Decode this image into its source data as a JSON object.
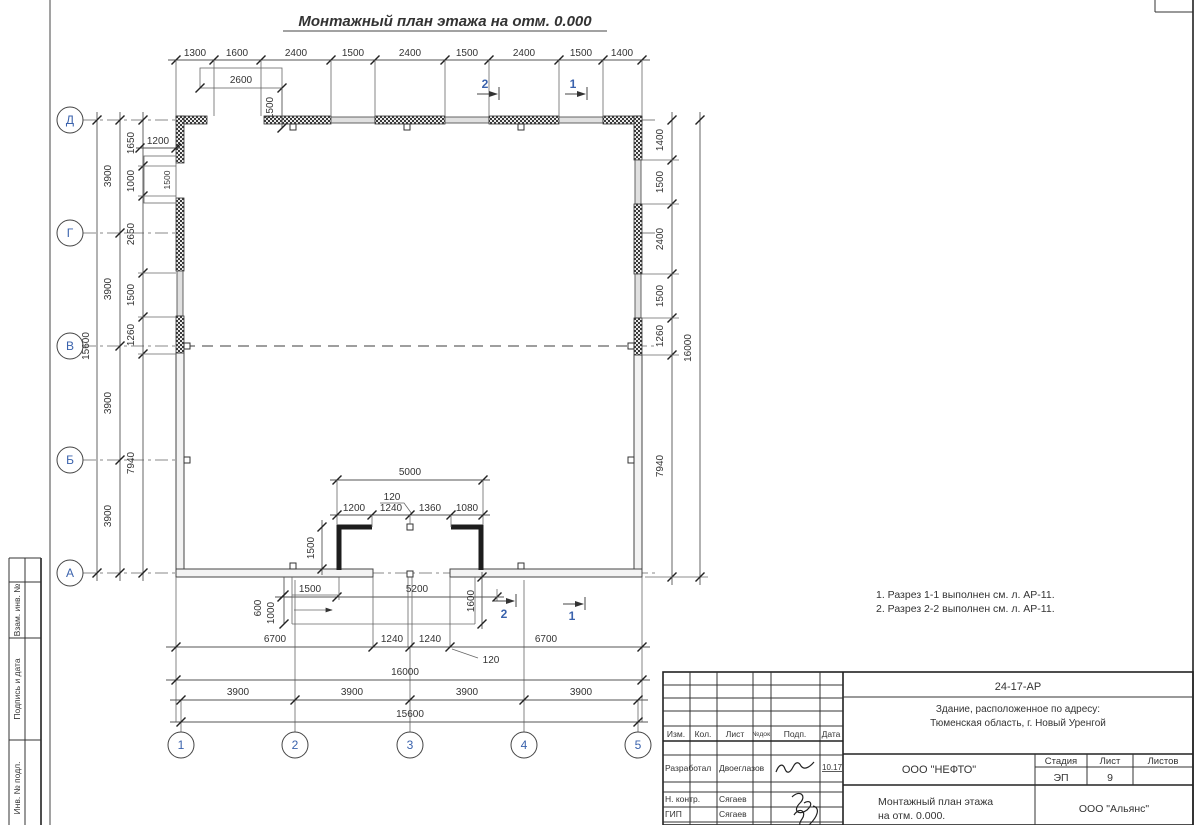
{
  "drawing": {
    "title": "Монтажный план этажа на отм. 0.000",
    "notes": [
      "1. Разрез 1-1 выполнен см. л. АР-11.",
      "2. Разрез 2-2 выполнен см. л. АР-11."
    ]
  },
  "axes": {
    "rows": [
      "Д",
      "Г",
      "В",
      "Б",
      "А"
    ],
    "cols": [
      "1",
      "2",
      "3",
      "4",
      "5"
    ]
  },
  "sections": {
    "s1": "1",
    "s2": "2"
  },
  "dims": {
    "top": [
      "1300",
      "1600",
      "2400",
      "1500",
      "2400",
      "1500",
      "2400",
      "1500",
      "1400"
    ],
    "top_box": "2600",
    "top_box_h": "1500",
    "left_feat_w": "1200",
    "left_feat_h": "1500",
    "left_total": "15600",
    "left_axis": [
      "3900",
      "3900",
      "3900",
      "3900"
    ],
    "left_chain": [
      "1650",
      "1000",
      "2650",
      "1500",
      "1260",
      "7940"
    ],
    "right_chain": [
      "1400",
      "1500",
      "2400",
      "1500",
      "1260",
      "7940"
    ],
    "right_total": "16000",
    "vest_total": "5000",
    "vest_gap": "120",
    "vest_chain": [
      "1200",
      "1240",
      "1360",
      "1080"
    ],
    "vest_h": "1500",
    "porch_a": "1500",
    "porch_b": "5200",
    "porch_c": "600",
    "porch_d": "1000",
    "porch_e": "1600",
    "bottom_chain": [
      "6700",
      "1240",
      "1240",
      "6700"
    ],
    "bottom_gap": "120",
    "bottom_total": "16000",
    "bottom_axis": [
      "3900",
      "3900",
      "3900",
      "3900"
    ],
    "bottom_axis_total": "15600"
  },
  "stamp": {
    "doc": "24-17-АР",
    "object_line1": "Здание, расположенное по адресу:",
    "object_line2": "Тюменская область, г. Новый Уренгой",
    "header": [
      "Изм.",
      "Кол.",
      "Лист",
      "№док.",
      "Подп.",
      "Дата"
    ],
    "rows": [
      {
        "role": "Разработал",
        "name": "Двоеглазов",
        "date": "10.17"
      },
      {
        "role": "Н. контр.",
        "name": "Сягаев",
        "date": ""
      },
      {
        "role": "ГИП",
        "name": "Сягаев",
        "date": ""
      }
    ],
    "org": "ООО \"НЕФТО\"",
    "stage_label": "Стадия",
    "sheet_label": "Лист",
    "sheets_label": "Листов",
    "stage": "ЭП",
    "sheet": "9",
    "sheets": "",
    "plan_line1": "Монтажный план этажа",
    "plan_line2": "на отм. 0.000.",
    "firm": "ООО \"Альянс\""
  },
  "margin": {
    "cells": [
      "Взам. инв. №",
      "Подпись и дата",
      "Инв. № подл."
    ]
  },
  "colors": {
    "accent_blue": "#3a62ac",
    "line": "#444444"
  }
}
